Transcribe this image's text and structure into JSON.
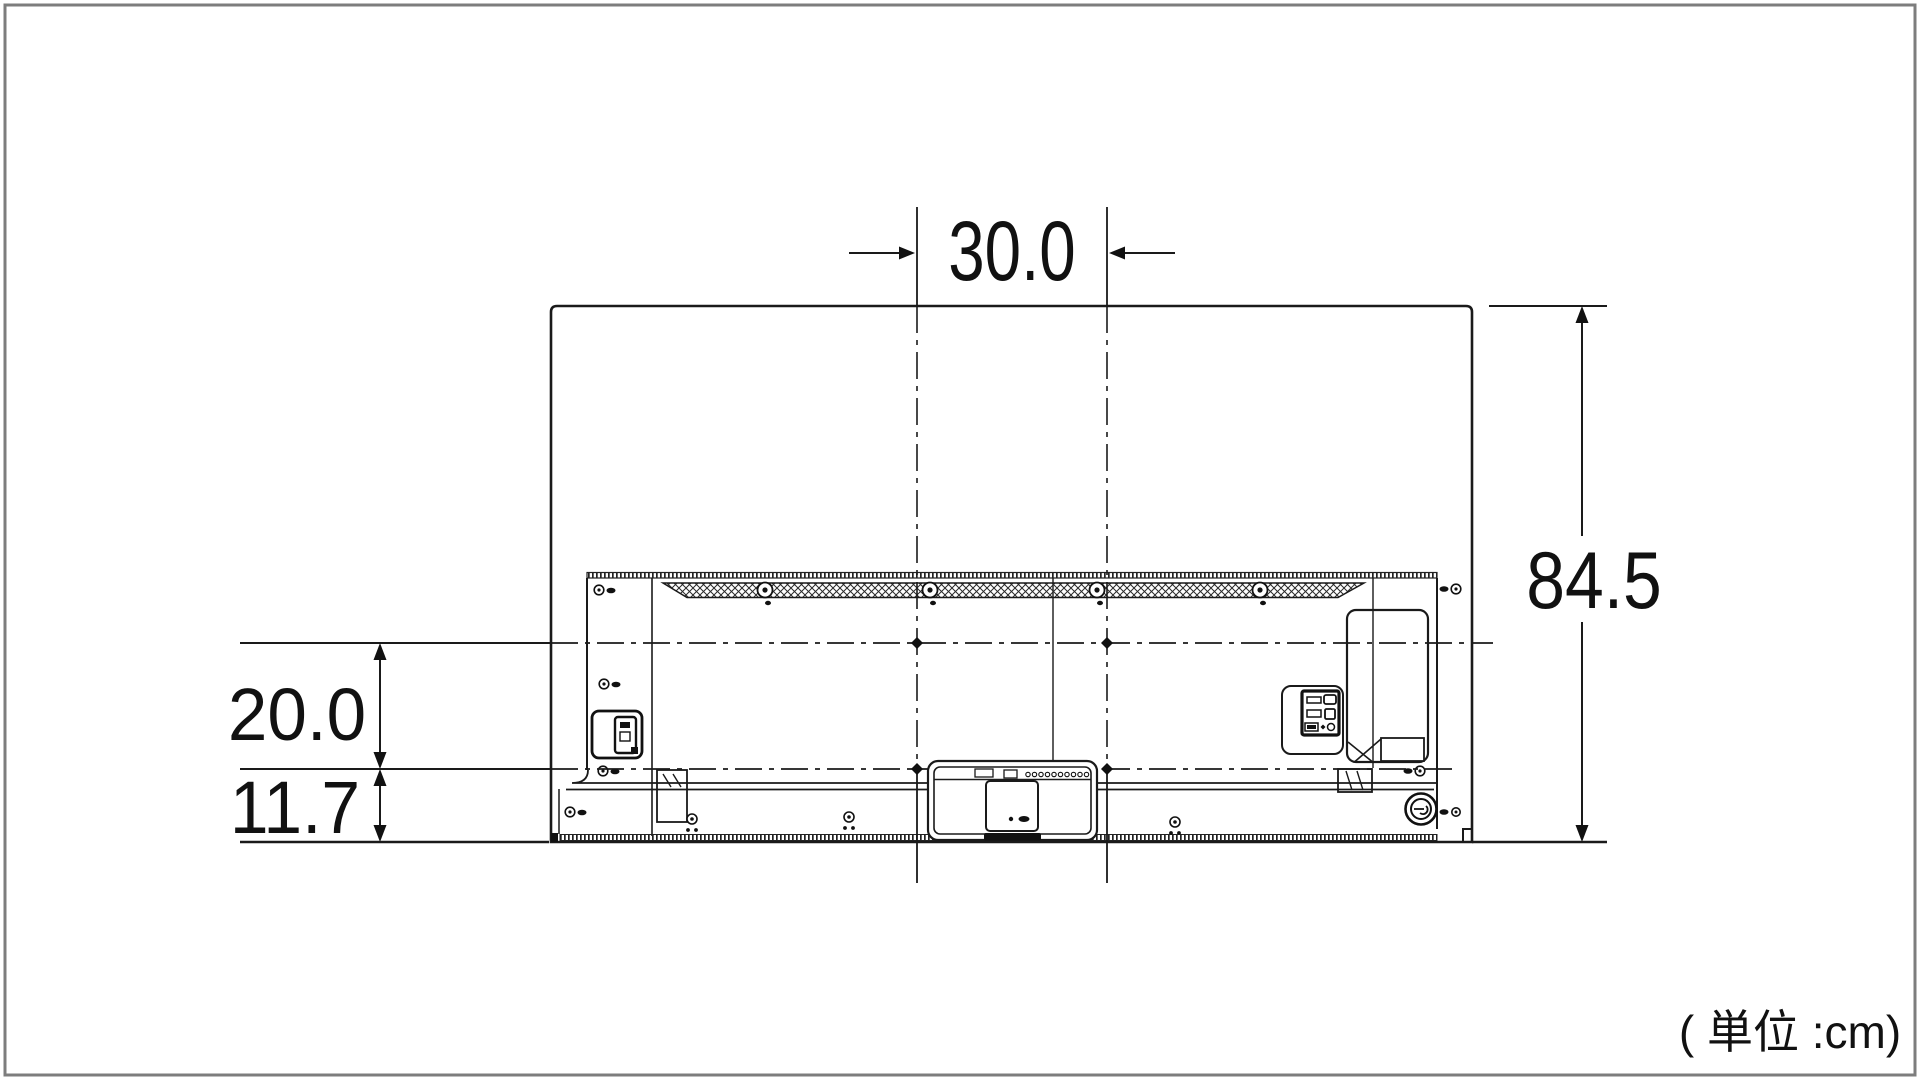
{
  "diagram": {
    "subject": "tv-rear-panel-dimension-drawing",
    "unit_note": "( 単位 :cm)",
    "dimensions": {
      "mount_width_cm": "30.0",
      "overall_height_cm": "84.5",
      "mount_to_lower_mount_cm": "20.0",
      "lower_mount_to_bottom_cm": "11.7"
    },
    "colors": {
      "line": "#1a1a1a",
      "fill": "#111111",
      "frame_border": "#7d7d7d",
      "background": "#ffffff"
    }
  }
}
